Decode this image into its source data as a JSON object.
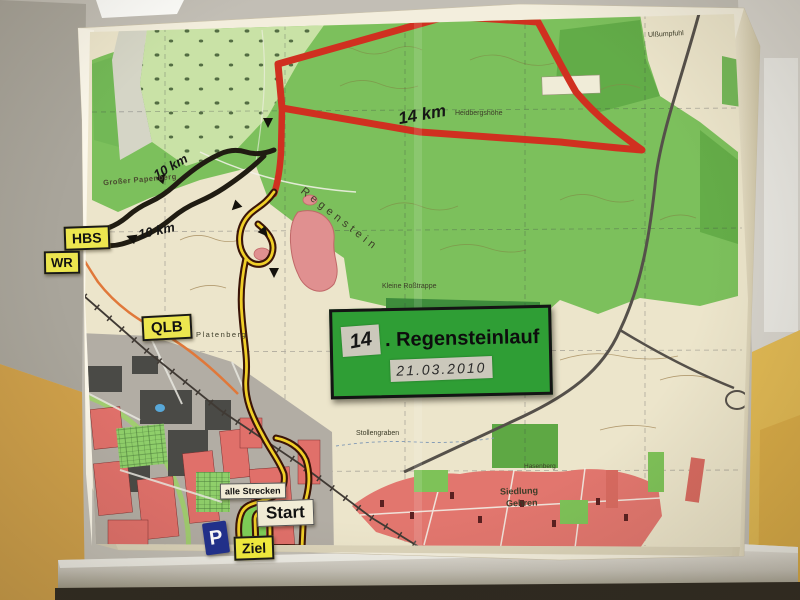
{
  "event_sign": {
    "number": "14",
    "title": ". Regensteinlauf",
    "date": "21.03.2010"
  },
  "signs": {
    "hbs": "HBS",
    "wr": "WR",
    "qlb": "QLB",
    "start": "Start",
    "ziel": "Ziel",
    "all_courses": "alle Strecken",
    "parking": "P"
  },
  "route_labels": {
    "red": "14 km",
    "black_a": "10 km",
    "black_b": "10 km"
  },
  "places": {
    "papenberg": "Großer Papenberg",
    "regenstein": "Regenstein",
    "rosstrappe": "Kleine Roßtrappe",
    "heidberg": "Heidbergshöhe",
    "sumpfuhl": "Ulßumpfuhl",
    "platenberg": "Platenberg",
    "stollengraben": "Stollengraben",
    "siedlung_line1": "Siedlung",
    "siedlung_line2": "Gehren",
    "hasenberg": "Hasenberg"
  },
  "colors": {
    "route_red": "#d03020",
    "route_black": "#201c12",
    "route_yellow": "#f0cf28",
    "sign_green": "#2f9e35",
    "sign_yellow": "#ece64f",
    "parking_blue": "#20308e",
    "forest_green": "#7cc05c",
    "rock_pink": "#e09090",
    "town_red": "#e0706a",
    "wall_yellow": "#d8ab4a",
    "paper_cream": "#f3eedd"
  }
}
